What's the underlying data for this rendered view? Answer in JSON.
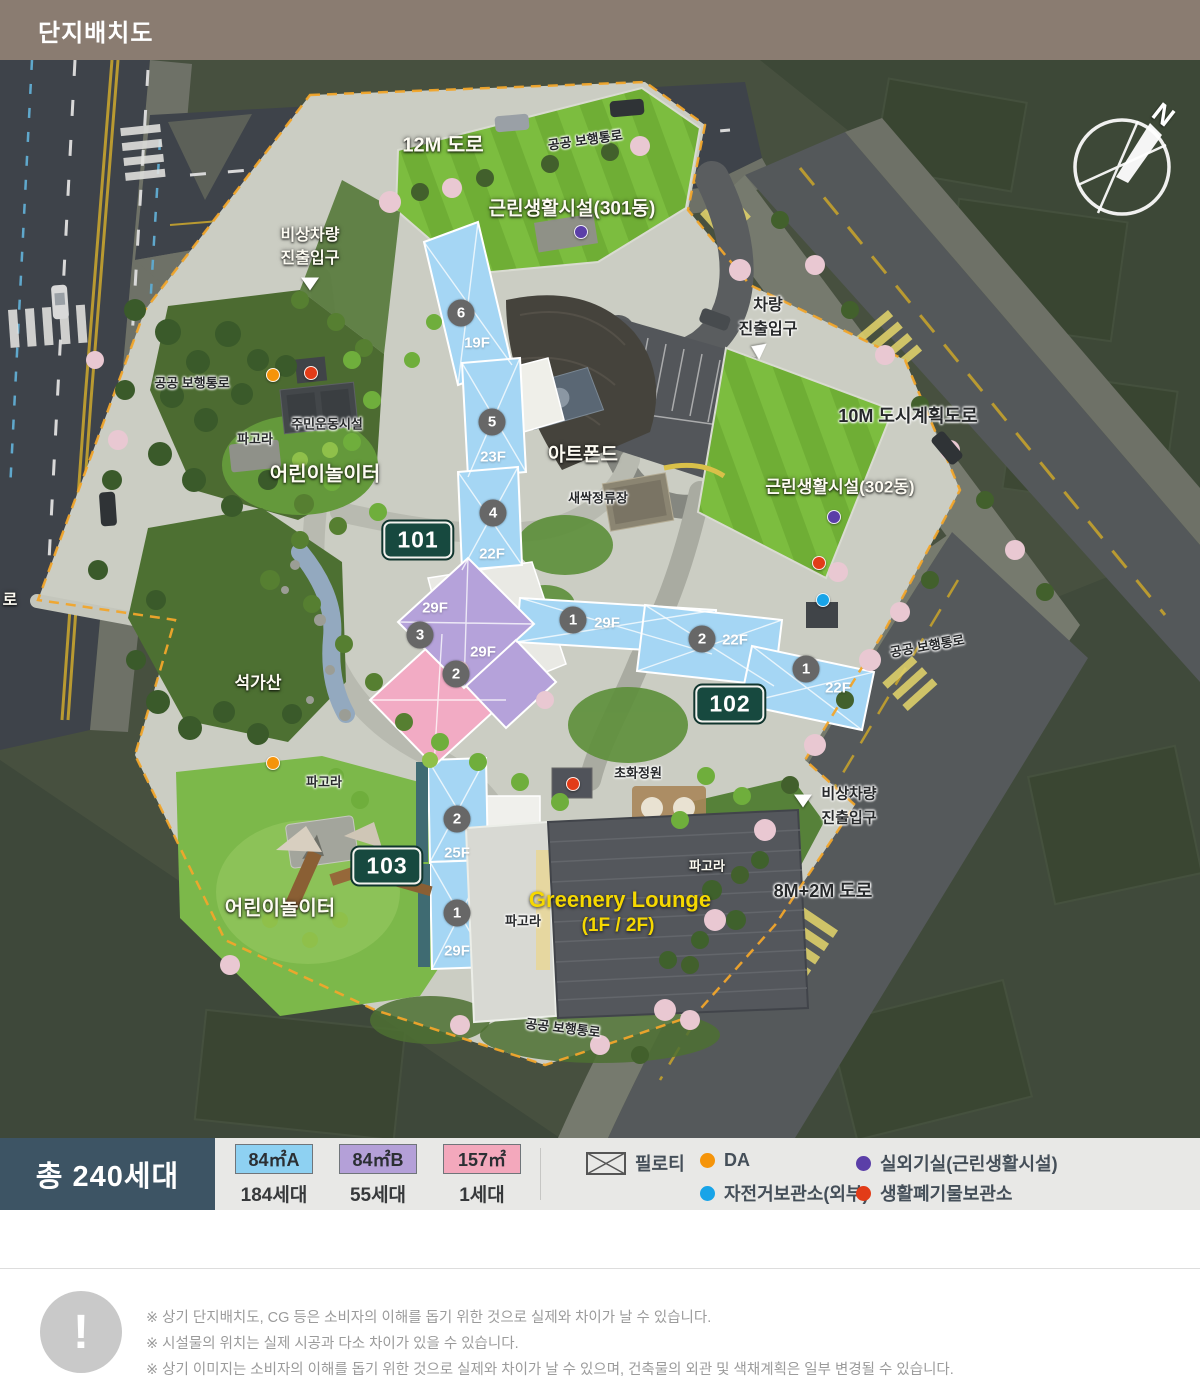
{
  "header": {
    "title": "단지배치도"
  },
  "map": {
    "compass_n": "N",
    "labels": {
      "road_12m": "12M 도로",
      "walk_top": "공공 보행통로",
      "facility_301": "근린생활시설(301동)",
      "emergency_top_1": "비상차량",
      "emergency_top_2": "진출입구",
      "walk_left": "공공 보행통로",
      "sports": "주민운동시설",
      "pergola_ul": "파고라",
      "playground_upper": "어린이놀이터",
      "artpond": "아트폰드",
      "sprout_stop": "새싹정류장",
      "seokgasan": "석가산",
      "pergola_left": "파고라",
      "playground_lower": "어린이놀이터",
      "flower_garden": "초화정원",
      "lounge_1": "Greenery Lounge",
      "lounge_2": "(1F / 2F)",
      "pergola_right": "파고라",
      "pergola_center": "파고라",
      "vehicle_1": "차량",
      "vehicle_2": "진출입구",
      "road_10m": "10M 도시계획도로",
      "facility_302": "근린생활시설(302동)",
      "emergency_br_1": "비상차량",
      "emergency_br_2": "진출입구",
      "road_8m": "8M+2M 도로",
      "walk_bottom": "공공 보행통로",
      "walk_right": "공공 보행통로",
      "road_left_partial": "로"
    },
    "badges": {
      "b101": "101",
      "b102": "102",
      "b103": "103"
    },
    "towers": {
      "a6": {
        "no": "6",
        "fl": "19F"
      },
      "a5": {
        "no": "5",
        "fl": "23F"
      },
      "a4": {
        "no": "4",
        "fl": "22F"
      },
      "a3": {
        "no": "3",
        "fl_upper": "29F",
        "fl_lower": "29F"
      },
      "a2": {
        "no": "2"
      },
      "a1": {
        "no": "1",
        "fl": "29F"
      },
      "b2": {
        "no": "2",
        "fl": "22F"
      },
      "b1": {
        "no": "1",
        "fl": "22F"
      },
      "c2": {
        "no": "2",
        "fl": "25F"
      },
      "c1": {
        "no": "1",
        "fl": "29F"
      }
    },
    "markers": {
      "da": "#f5940a",
      "outdoor_unit": "#5b3fa8",
      "bicycle": "#18a4e8",
      "waste": "#e23c18"
    },
    "unit_colors": {
      "type_a": "#a5d6f4",
      "type_b": "#b5a2da",
      "type_c": "#f2abc4"
    }
  },
  "legend": {
    "total": "총 240세대",
    "unit_types": [
      {
        "label": "84㎡A",
        "count": "184세대",
        "color": "#8ed1f2"
      },
      {
        "label": "84㎡B",
        "count": "55세대",
        "color": "#b4a0d8"
      },
      {
        "label": "157㎡",
        "count": "1세대",
        "color": "#f3a8bc"
      }
    ],
    "items": {
      "piloti": {
        "label": "필로티",
        "symbol": "hatched-box"
      },
      "da": {
        "label": "DA",
        "color": "#f5940a"
      },
      "outdoor_unit": {
        "label": "실외기실(근린생활시설)",
        "color": "#5b3fa8"
      },
      "bicycle": {
        "label": "자전거보관소(외부)",
        "color": "#18a4e8"
      },
      "waste": {
        "label": "생활폐기물보관소",
        "color": "#e23c18"
      }
    }
  },
  "disclaimer": {
    "icon_mark": "!",
    "lines": [
      "※ 상기 단지배치도, CG 등은 소비자의 이해를 돕기 위한 것으로 실제와 차이가 날 수 있습니다.",
      "※ 시설물의 위치는 실제 시공과 다소 차이가 있을 수 있습니다.",
      "※ 상기 이미지는 소비자의 이해를 돕기 위한 것으로 실제와 차이가 날 수 있으며, 건축물의 외관 및 색채계획은 일부 변경될 수 있습니다."
    ]
  }
}
